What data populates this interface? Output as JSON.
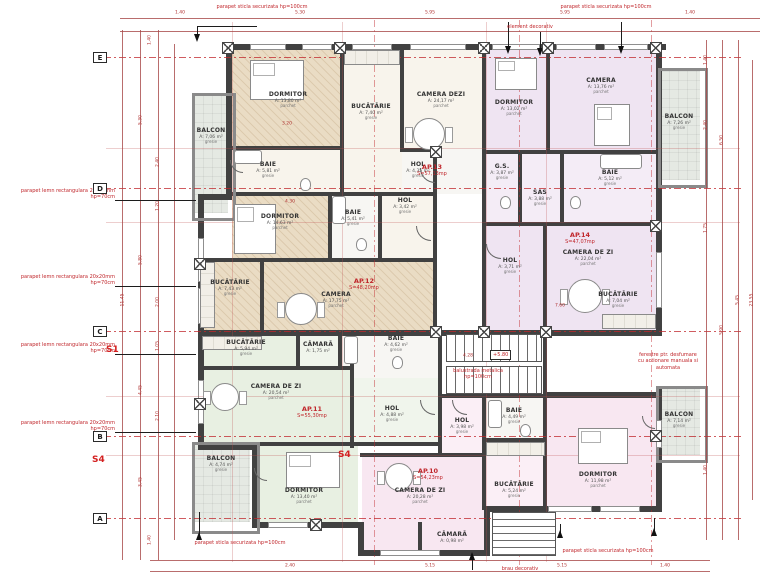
{
  "grid": {
    "rows": [
      "E",
      "D",
      "C",
      "B",
      "A"
    ]
  },
  "sections": {
    "s1": "S1",
    "s4": "S4"
  },
  "apartments": [
    {
      "id": "AP.13",
      "area": "S=57,13mp"
    },
    {
      "id": "AP.14",
      "area": "S=47,07mp"
    },
    {
      "id": "AP.12",
      "area": "S=48,20mp"
    },
    {
      "id": "AP.11",
      "area": "S=55,30mp"
    },
    {
      "id": "AP.10",
      "area": "S=54,23mp"
    }
  ],
  "rooms": [
    {
      "name": "BALCON",
      "area": "A: 7,06 m²",
      "fin": "gresie"
    },
    {
      "name": "DORMITOR",
      "area": "A: 13,80 m²",
      "fin": "parchet"
    },
    {
      "name": "BUCĂTĂRIE",
      "area": "A: 7,40 m²",
      "fin": "gresie"
    },
    {
      "name": "CAMERA DEZI",
      "area": "A: 24,17 m²",
      "fin": "parchet"
    },
    {
      "name": "BAIE",
      "area": "A: 5,81 m²",
      "fin": "gresie"
    },
    {
      "name": "HOL",
      "area": "A: 4,35 m²",
      "fin": "gresie"
    },
    {
      "name": "DORMITOR",
      "area": "A: 13,02 m²",
      "fin": "parchet"
    },
    {
      "name": "CAMERA",
      "area": "A: 13,76 m²",
      "fin": "parchet"
    },
    {
      "name": "BALCON",
      "area": "A: 7,26 m²",
      "fin": "gresie"
    },
    {
      "name": "G.S.",
      "area": "A: 3,87 m²",
      "fin": "gresie"
    },
    {
      "name": "SAS",
      "area": "A: 3,88 m²",
      "fin": "gresie"
    },
    {
      "name": "BAIE",
      "area": "A: 5,12 m²",
      "fin": "gresie"
    },
    {
      "name": "HOL",
      "area": "A: 3,71 m²",
      "fin": "gresie"
    },
    {
      "name": "CAMERA DE ZI",
      "area": "A: 22,04 m²",
      "fin": "parchet"
    },
    {
      "name": "BUCĂTĂRIE",
      "area": "A: 7,04 m²",
      "fin": "gresie"
    },
    {
      "name": "DORMITOR",
      "area": "A: 14,63 m²",
      "fin": "parchet"
    },
    {
      "name": "BAIE",
      "area": "A: 5,41 m²",
      "fin": "gresie"
    },
    {
      "name": "HOL",
      "area": "A: 3,42 m²",
      "fin": "gresie"
    },
    {
      "name": "BUCĂTĂRIE",
      "area": "A: 7,43 m²",
      "fin": "gresie"
    },
    {
      "name": "CAMERA",
      "area": "A: 17,75 m²",
      "fin": "parchet"
    },
    {
      "name": "BUCĂTĂRIE",
      "area": "A: 5,94 m²",
      "fin": "gresie"
    },
    {
      "name": "CĂMARĂ",
      "area": "A: 1,75 m²",
      "fin": "gresie"
    },
    {
      "name": "BAIE",
      "area": "A: 4,62 m²",
      "fin": "gresie"
    },
    {
      "name": "CAMERA DE ZI",
      "area": "A: 20,54 m²",
      "fin": "parchet"
    },
    {
      "name": "HOL",
      "area": "A: 4,88 m²",
      "fin": "gresie"
    },
    {
      "name": "BALCON",
      "area": "A: 4,74 m²",
      "fin": "gresie"
    },
    {
      "name": "DORMITOR",
      "area": "A: 13,40 m²",
      "fin": "parchet"
    },
    {
      "name": "HOL",
      "area": "A: 3,98 m²",
      "fin": "gresie"
    },
    {
      "name": "BAIE",
      "area": "A: 4,49 m²",
      "fin": "gresie"
    },
    {
      "name": "BALCON",
      "area": "A: 7,14 m²",
      "fin": "gresie"
    },
    {
      "name": "DORMITOR",
      "area": "A: 11,98 m²",
      "fin": "parchet"
    },
    {
      "name": "CAMERA DE ZI",
      "area": "A: 20,28 m²",
      "fin": "parchet"
    },
    {
      "name": "BUCĂTĂRIE",
      "area": "A: 5,24 m²",
      "fin": "gresie"
    },
    {
      "name": "CĂMARĂ",
      "area": "A: 0,98 m²",
      "fin": "gresie"
    }
  ],
  "annotations": {
    "glass_parapet": "parapet sticla securizata hp=100cm",
    "wood_parapet": "parapet lemn rectangulara 20x20mm hp=70cm",
    "element_decorativ": "element decorativ",
    "brau_decorativ": "brau decorativ",
    "balustrade": "balustrada metalica hp=100cm",
    "smoke_windows": "ferestre ptr. desfumare cu actionare manuala si automata"
  },
  "dims": {
    "top": [
      "1.40",
      "5.30",
      "5.95",
      "5.95",
      "1.40"
    ],
    "left": [
      "1.40",
      "5.30",
      "2.40",
      "1.20",
      "5.80",
      "11.45",
      "2.00",
      "1.05",
      "4.45",
      "2.10",
      "3.45",
      "1.40"
    ],
    "right": [
      "1.40",
      "2.40",
      "6.50",
      "1.75",
      "5.90",
      "5.45",
      "23.55",
      "1.40"
    ],
    "bottom": [
      "2.40",
      "5.15",
      "5.15",
      "1.40"
    ],
    "interior": [
      "3.20",
      "4.30",
      "7.60",
      "4.28"
    ],
    "level": "+5.80"
  }
}
